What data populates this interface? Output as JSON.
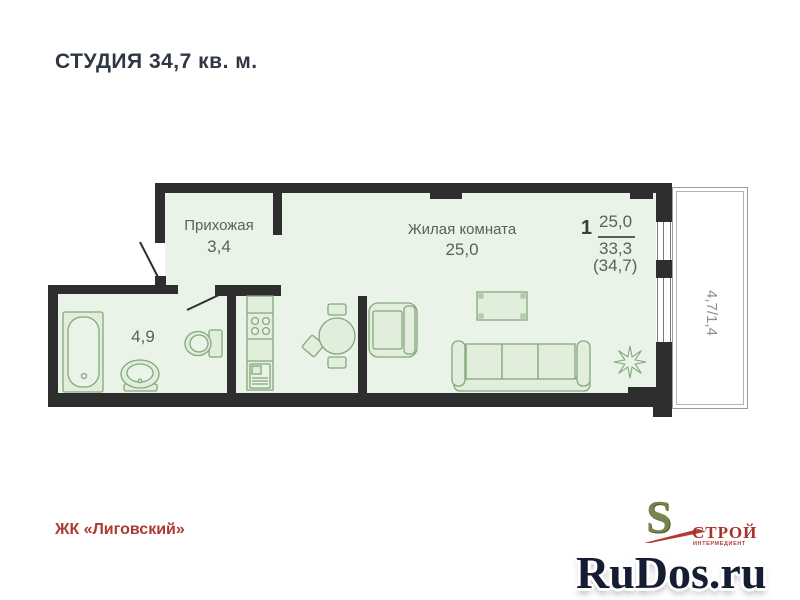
{
  "title": "СТУДИЯ 34,7 кв. м.",
  "plan": {
    "hallway": {
      "label": "Прихожая",
      "area": "3,4"
    },
    "living": {
      "label": "Жилая комната",
      "area": "25,0"
    },
    "bathroom": {
      "area": "4,9"
    },
    "balcony": {
      "area": "4,7/1,4"
    },
    "summary": {
      "rooms": "1",
      "living_area": "25,0",
      "area_without_balcony": "33,3",
      "total_area": "(34,7)"
    }
  },
  "footer": {
    "complex": "ЖК «Лиговский»",
    "logo": {
      "letter": "S",
      "name": "СТРОЙ",
      "subtitle": "ИНТЕРМЕДИЕНТ"
    }
  },
  "watermark": {
    "text": "RuDos.ru"
  },
  "colors": {
    "wall": "#2e2e2e",
    "floor_fill": "#eaf3e8",
    "furniture_stroke": "#84a77b",
    "title_text": "#2f3744",
    "plan_text": "#5a615c",
    "brand_red": "#ad3a31",
    "logo_green": "#75854d",
    "watermark_navy": "#151d33"
  }
}
